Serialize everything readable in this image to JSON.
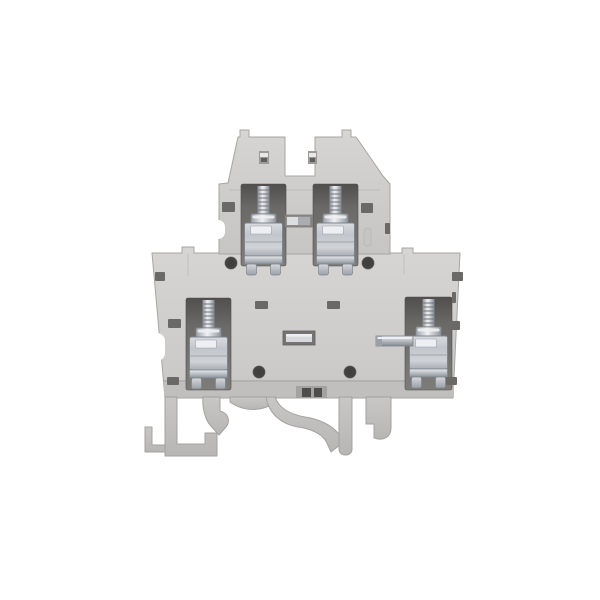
{
  "meta": {
    "type": "product-photo",
    "description": "Gray two-tier DIN-rail screw-clamp terminal block with four zinc-plated screw terminals, photographed front-on against a plain white background",
    "background": "#ffffff"
  },
  "colors": {
    "bg": "#ffffff",
    "body": "#d0cfce",
    "body-light": "#d6d5d4",
    "body-dark": "#c0bfbd",
    "outline": "#a6a5a3",
    "seam": "#b8b7b5",
    "recess": "#6d6c69",
    "recess-dark": "#504f4d",
    "hole": "#454443",
    "slot": "#6a6967",
    "metal-light": "#edeff2",
    "metal": "#c2c6cc",
    "metal-dark": "#8b9199",
    "foot": "#c8c7c5"
  },
  "object": {
    "name": "double-level-terminal-block",
    "levels": 2,
    "terminal_count": 4,
    "terminals": [
      "upper-left screw clamp",
      "upper-right screw clamp",
      "lower-left screw clamp",
      "lower-right screw clamp with cross-connect bar"
    ],
    "features": [
      "center jumper slot on upper level",
      "center jumper slot on lower level",
      "four round test holes",
      "DIN-rail mounting foot with spring latch"
    ]
  }
}
